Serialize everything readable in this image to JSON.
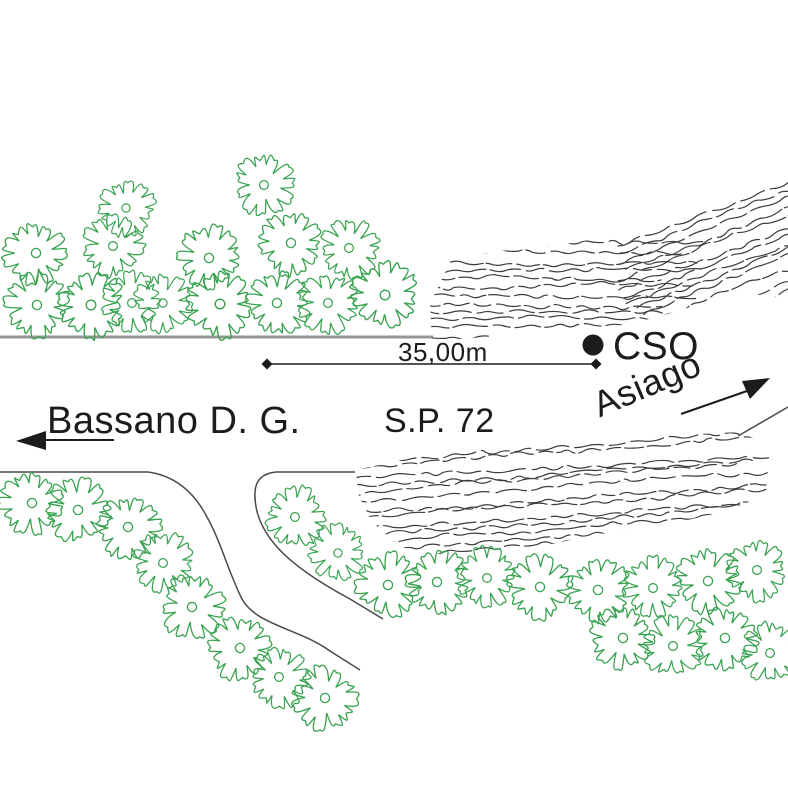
{
  "labels": {
    "station_marker": "CSO",
    "dimension": "35,00m",
    "direction_left": "Bassano D. G.",
    "road_name": "S.P. 72",
    "direction_right": "Asiago"
  },
  "colors": {
    "vegetation": "#37a24f",
    "ink": "#1c1c1c",
    "hatch": "#3c3c3c",
    "road_edge": "#969696",
    "curve_line": "#4a4a4a"
  }
}
